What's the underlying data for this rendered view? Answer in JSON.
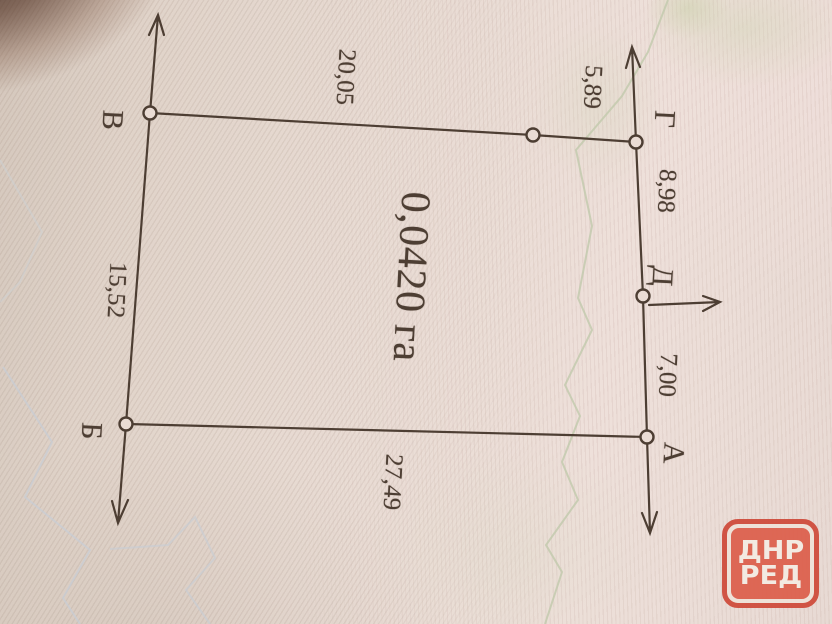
{
  "plot_plan": {
    "area_label": "0,0420 га",
    "vertices": {
      "v": "В",
      "g": "Г",
      "d": "Д",
      "a": "А",
      "b": "Б"
    },
    "measurements": {
      "v_g": "20,05",
      "mid_g": "5,89",
      "g_d": "8,98",
      "d_a": "7,00",
      "a_b": "27,49",
      "b_v": "15,52"
    }
  },
  "watermark": {
    "line1": "ДНР",
    "line2": "РЕД"
  },
  "colors": {
    "ink": "#4d3e33",
    "paper": "#e9dcd4",
    "watermark_red": "#d5513f",
    "contour_green": "#c3caae",
    "contour_blue": "#c7cdd6"
  }
}
